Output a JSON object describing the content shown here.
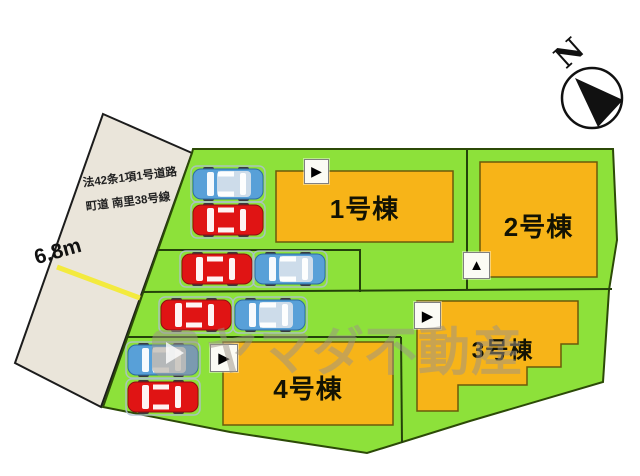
{
  "site_plan": {
    "road": {
      "regulation_line1": "法42条1項1号道路",
      "regulation_line2": "町道 南里38号線",
      "width_label": "6.8m",
      "surface_color": "#eae5da",
      "center_line_color": "#f3ea3e"
    },
    "compass": {
      "label": "N"
    },
    "land_color": "#8de13a",
    "building_color": "#f7b418",
    "buildings": [
      {
        "label": "1号棟",
        "marker_icon": "▶"
      },
      {
        "label": "2号棟",
        "marker_icon": "▲"
      },
      {
        "label": "3号棟",
        "marker_icon": "▶"
      },
      {
        "label": "4号棟",
        "marker_icon": "▶"
      }
    ],
    "cars": [
      {
        "color": "blue"
      },
      {
        "color": "red"
      },
      {
        "color": "red"
      },
      {
        "color": "blue"
      },
      {
        "color": "red"
      },
      {
        "color": "blue"
      },
      {
        "color": "blue"
      },
      {
        "color": "red"
      }
    ],
    "watermark": {
      "text": "ヤマダ不動産"
    }
  }
}
